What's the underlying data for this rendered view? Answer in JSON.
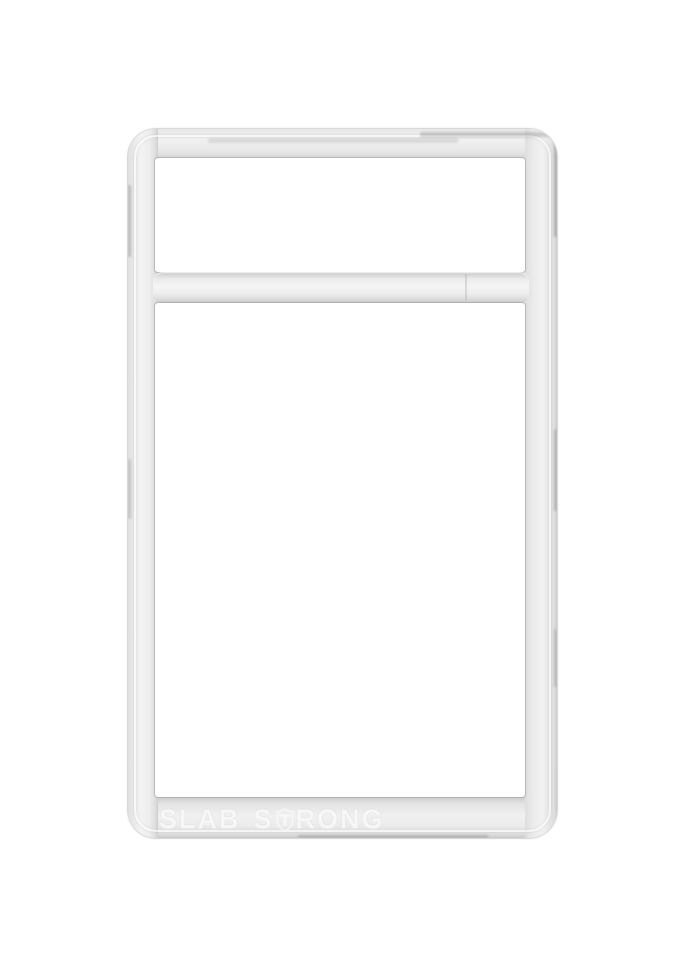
{
  "emboss": {
    "word1": "SLAB",
    "word2_prefix": "S",
    "word2_suffix": "RONG",
    "shield_icon": "shield-t-icon"
  },
  "colors": {
    "background": "#ffffff",
    "plastic_base": "#e9e9e9",
    "plastic_highlight": "#f4f4f4",
    "plastic_shadow": "#cfcfcf",
    "edge_gray": "#a8a8a8",
    "emboss": "#f7f7f7"
  }
}
